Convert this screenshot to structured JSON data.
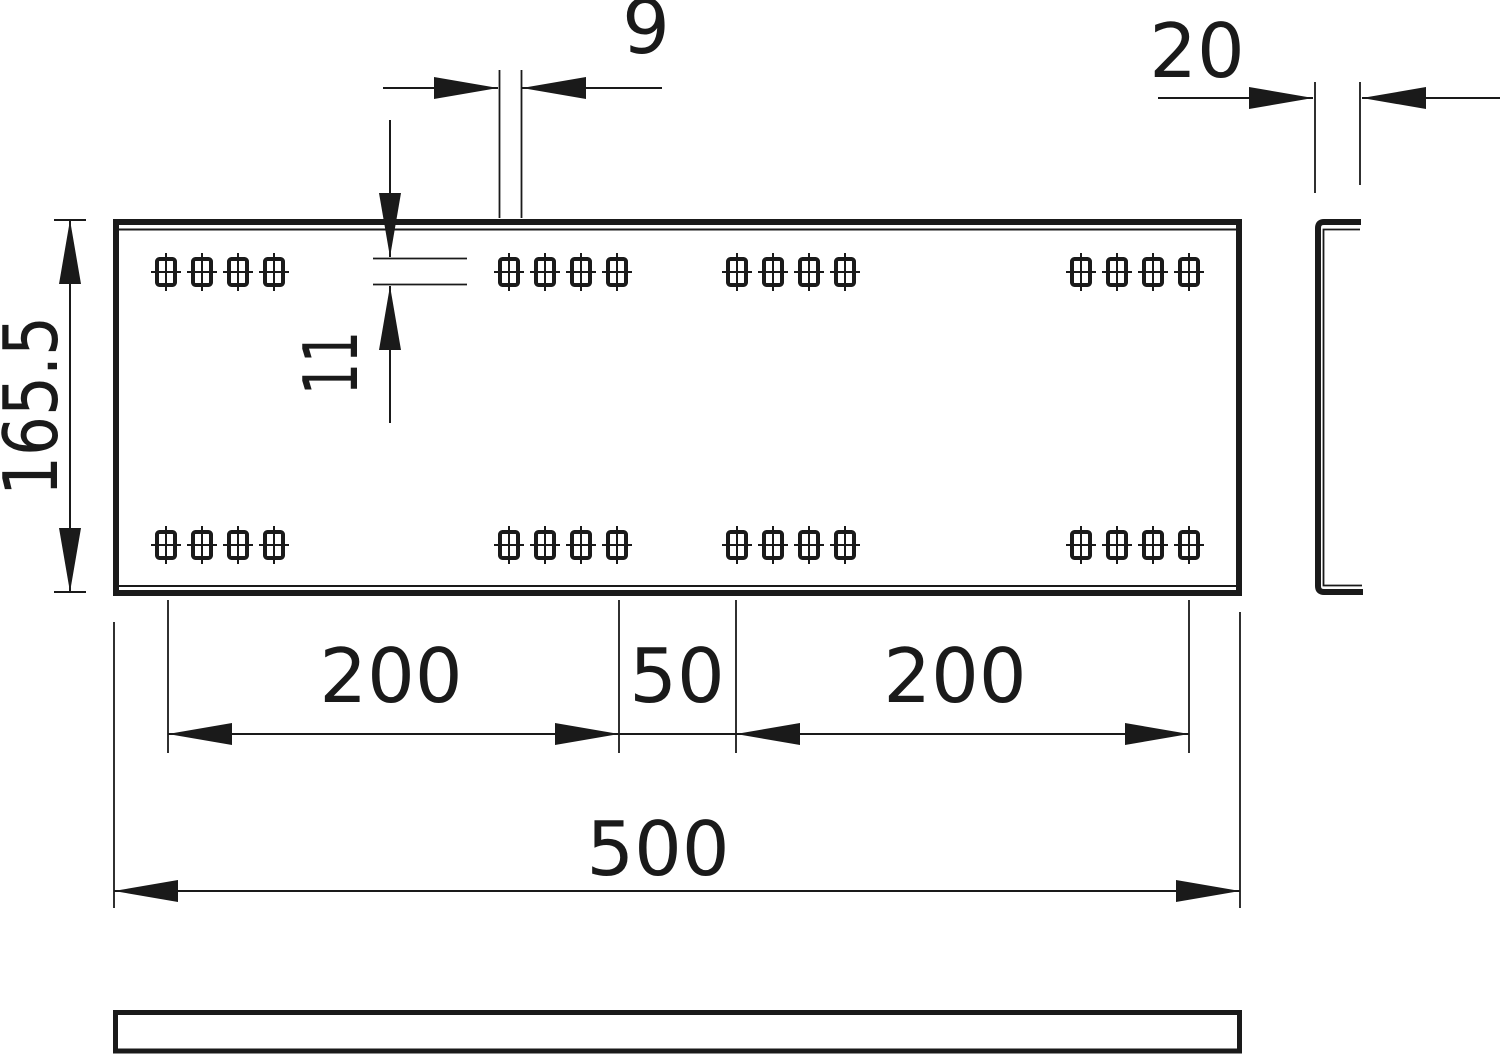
{
  "drawing": {
    "kind": "technical-dimension-drawing",
    "colors": {
      "line": "#1a1a1a",
      "background": "#ffffff"
    },
    "dimensions": {
      "hole_width": "9",
      "hole_height": "11",
      "plate_height": "165.5",
      "flange_depth": "20",
      "pitch_left": "200",
      "pitch_mid": "50",
      "pitch_right": "200",
      "overall_width": "500"
    }
  }
}
